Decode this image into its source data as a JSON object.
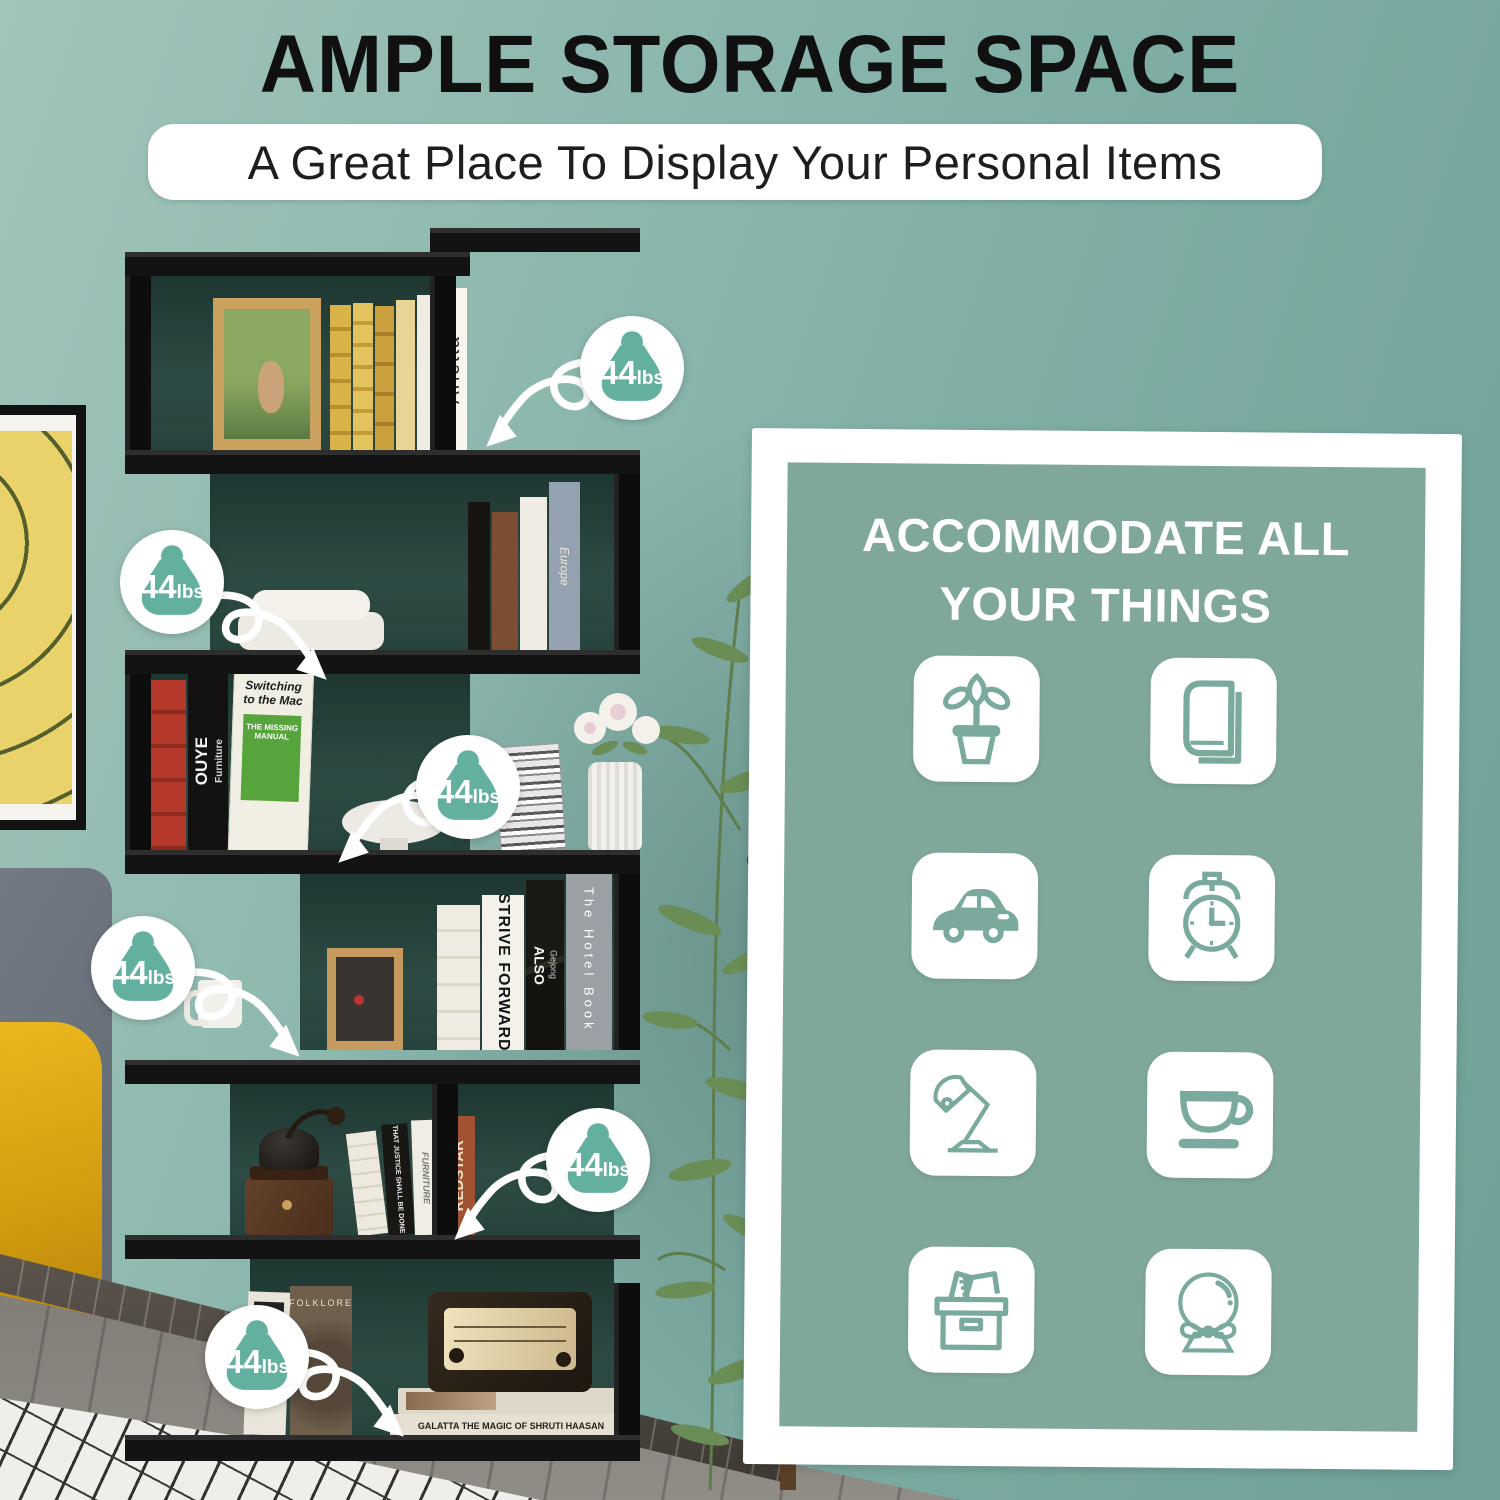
{
  "header": {
    "title": "AMPLE STORAGE SPACE",
    "subtitle": "A Great Place To Display Your Personal Items"
  },
  "weight_badges": {
    "capacity_per_shelf": "44lbs",
    "items": [
      {
        "value": "44",
        "unit": "lbs",
        "shelf": "tier-1"
      },
      {
        "value": "44",
        "unit": "lbs",
        "shelf": "tier-2"
      },
      {
        "value": "44",
        "unit": "lbs",
        "shelf": "tier-3"
      },
      {
        "value": "44",
        "unit": "lbs",
        "shelf": "tier-4"
      },
      {
        "value": "44",
        "unit": "lbs",
        "shelf": "tier-5"
      },
      {
        "value": "44",
        "unit": "lbs",
        "shelf": "tier-6"
      }
    ]
  },
  "panel": {
    "heading_line1": "ACCOMMODATE ALL",
    "heading_line2": "YOUR THINGS",
    "icons": [
      {
        "name": "potted-plant"
      },
      {
        "name": "book"
      },
      {
        "name": "car"
      },
      {
        "name": "alarm-clock"
      },
      {
        "name": "desk-lamp"
      },
      {
        "name": "coffee-cup"
      },
      {
        "name": "storage-box"
      },
      {
        "name": "crystal-ball"
      }
    ]
  },
  "photo": {
    "book_spines": {
      "arietta": "Arietta",
      "europe": "Europe",
      "ouye": "OUYE",
      "ouye_sub": "Furniture",
      "switching_title": "Switching to the Mac",
      "switching_sub": "THE MISSING MANUAL",
      "strive": "STRIVE FORWARD",
      "also": "ALSO",
      "also_sub": "Gejong",
      "hotel": "The Hotel Book",
      "justice": "THAT JUSTICE SHALL BE DONE",
      "furniture": "FURNITURE",
      "redstar": "REDSTAR",
      "folklore": "FOLKLORE",
      "galatta": "GALATTA  THE MAGIC OF SHRUTI HAASAN"
    }
  },
  "colors": {
    "wall": "#86b3aa",
    "panel": "#7fa89a",
    "badge": "#63b0a1",
    "icon": "#79aa9d",
    "shelf": "#141414",
    "accent_yellow": "#dfa616"
  }
}
